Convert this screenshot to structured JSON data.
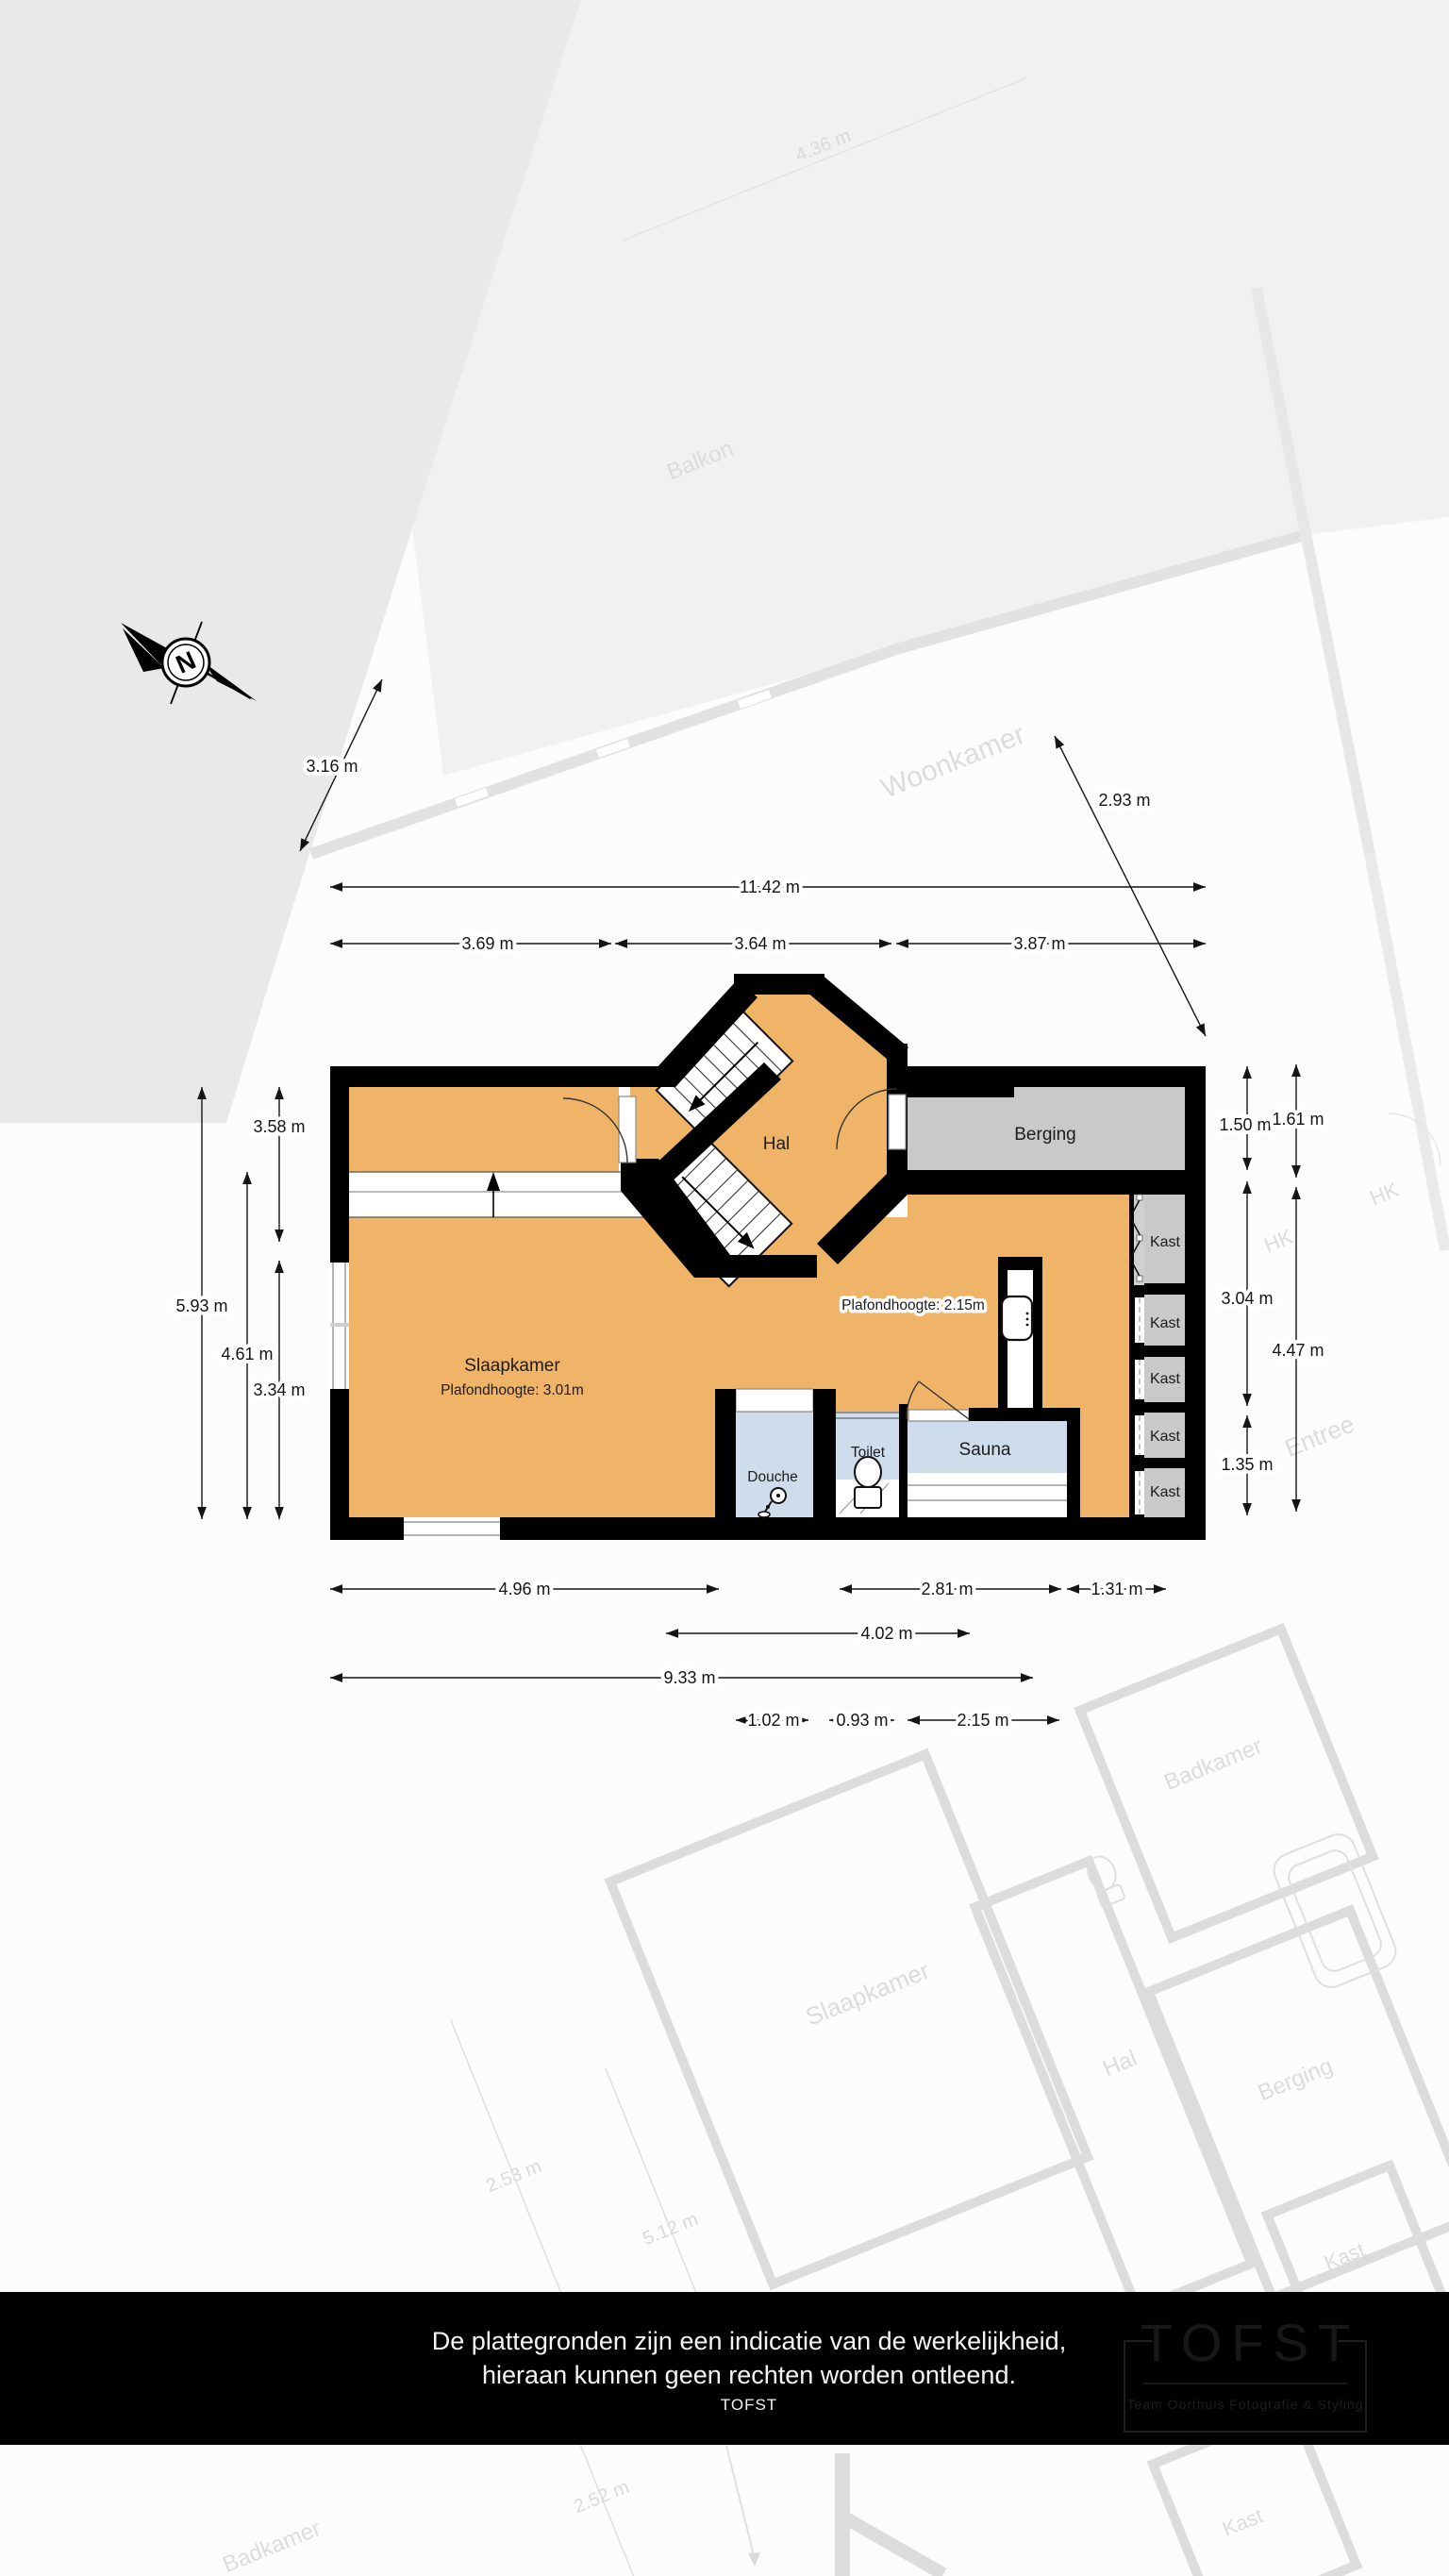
{
  "compass": {
    "north": "N"
  },
  "rooms": {
    "hal": "Hal",
    "berging": "Berging",
    "slaapkamer": "Slaapkamer",
    "douche": "Douche",
    "toilet": "Toilet",
    "sauna": "Sauna",
    "kast": "Kast"
  },
  "notes": {
    "ceiling_high": "Plafondhoogte: 3.01m",
    "ceiling_low": "Plafondhoogte: 2.15m"
  },
  "dims": {
    "t1": "3.16 m",
    "t2": "2.93 m",
    "t3": "11.42 m",
    "t4": "3.69 m",
    "t5": "3.64 m",
    "t6": "3.87 m",
    "l1": "3.58 m",
    "l2": "5.93 m",
    "l3": "4.61 m",
    "l4": "3.34 m",
    "r1": "1.50 m",
    "r2": "1.61 m",
    "r3": "3.04 m",
    "r4": "4.47 m",
    "r5": "1.35 m",
    "b1": "4.96 m",
    "b2": "2.81 m",
    "b3": "1.31 m",
    "b4": "4.02 m",
    "b5": "9.33 m",
    "b6": "1.02 m",
    "b7": "0.93 m",
    "b8": "2.15 m"
  },
  "ghost": {
    "woonkamer": "Woonkamer",
    "balkon": "Balkon",
    "hk": "HK",
    "entree": "Entree",
    "slaapkamer": "Slaapkamer",
    "hal": "Hal",
    "berging": "Berging",
    "kast": "Kast",
    "badkamer": "Badkamer",
    "g1": "4.36 m",
    "g2": "2.53 m",
    "g3": "5.12 m",
    "g4": "2.52 m"
  },
  "footer": {
    "line1": "De plattegronden zijn een indicatie van de werkelijkheid,",
    "line2": "hieraan kunnen geen rechten worden ontleend.",
    "line3": "TOFST"
  },
  "logo": {
    "title": "TOFST",
    "subtitle": "Team Oorthuis Fotografie & Styling"
  },
  "colors": {
    "floor": "#f0b469",
    "wet": "#cfdcec",
    "cabinet": "#c9c9c9",
    "wall": "#000000",
    "bar": "#000000"
  }
}
